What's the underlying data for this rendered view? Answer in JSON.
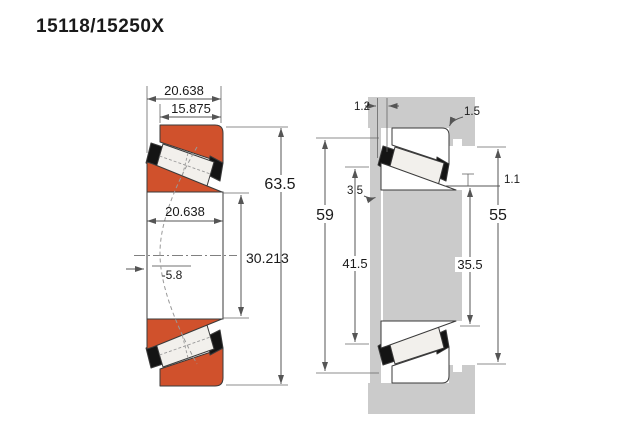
{
  "title": "15118/15250X",
  "colors": {
    "ring_fill": "#d0512c",
    "roller_fill": "#f2f0ec",
    "cage_fill": "#141414",
    "housing_fill": "#cbcbcb",
    "outline": "#3a3a3a",
    "dim_line": "#555555",
    "text": "#1a1a1a",
    "background": "#ffffff"
  },
  "left_view": {
    "description": "bearing cross-section",
    "dims": {
      "total_width": "20.638",
      "cup_width": "15.875",
      "outer_diameter": "63.5",
      "cone_width": "20.638",
      "bore_diameter": "30.213",
      "load_center_offset": "-5.8"
    }
  },
  "right_view": {
    "description": "mounting abutment and fillet dimensions",
    "dims": {
      "side_gap": "1.2",
      "housing_fillet_radius": "1.5",
      "shoulder_offset": "3.5",
      "cup_face_clearance": "1.1",
      "shaft_shoulder_outer_diameter": "59",
      "shaft_abutment_diameter": "41.5",
      "recess_diameter": "35.5",
      "housing_abutment_diameter": "55"
    }
  }
}
